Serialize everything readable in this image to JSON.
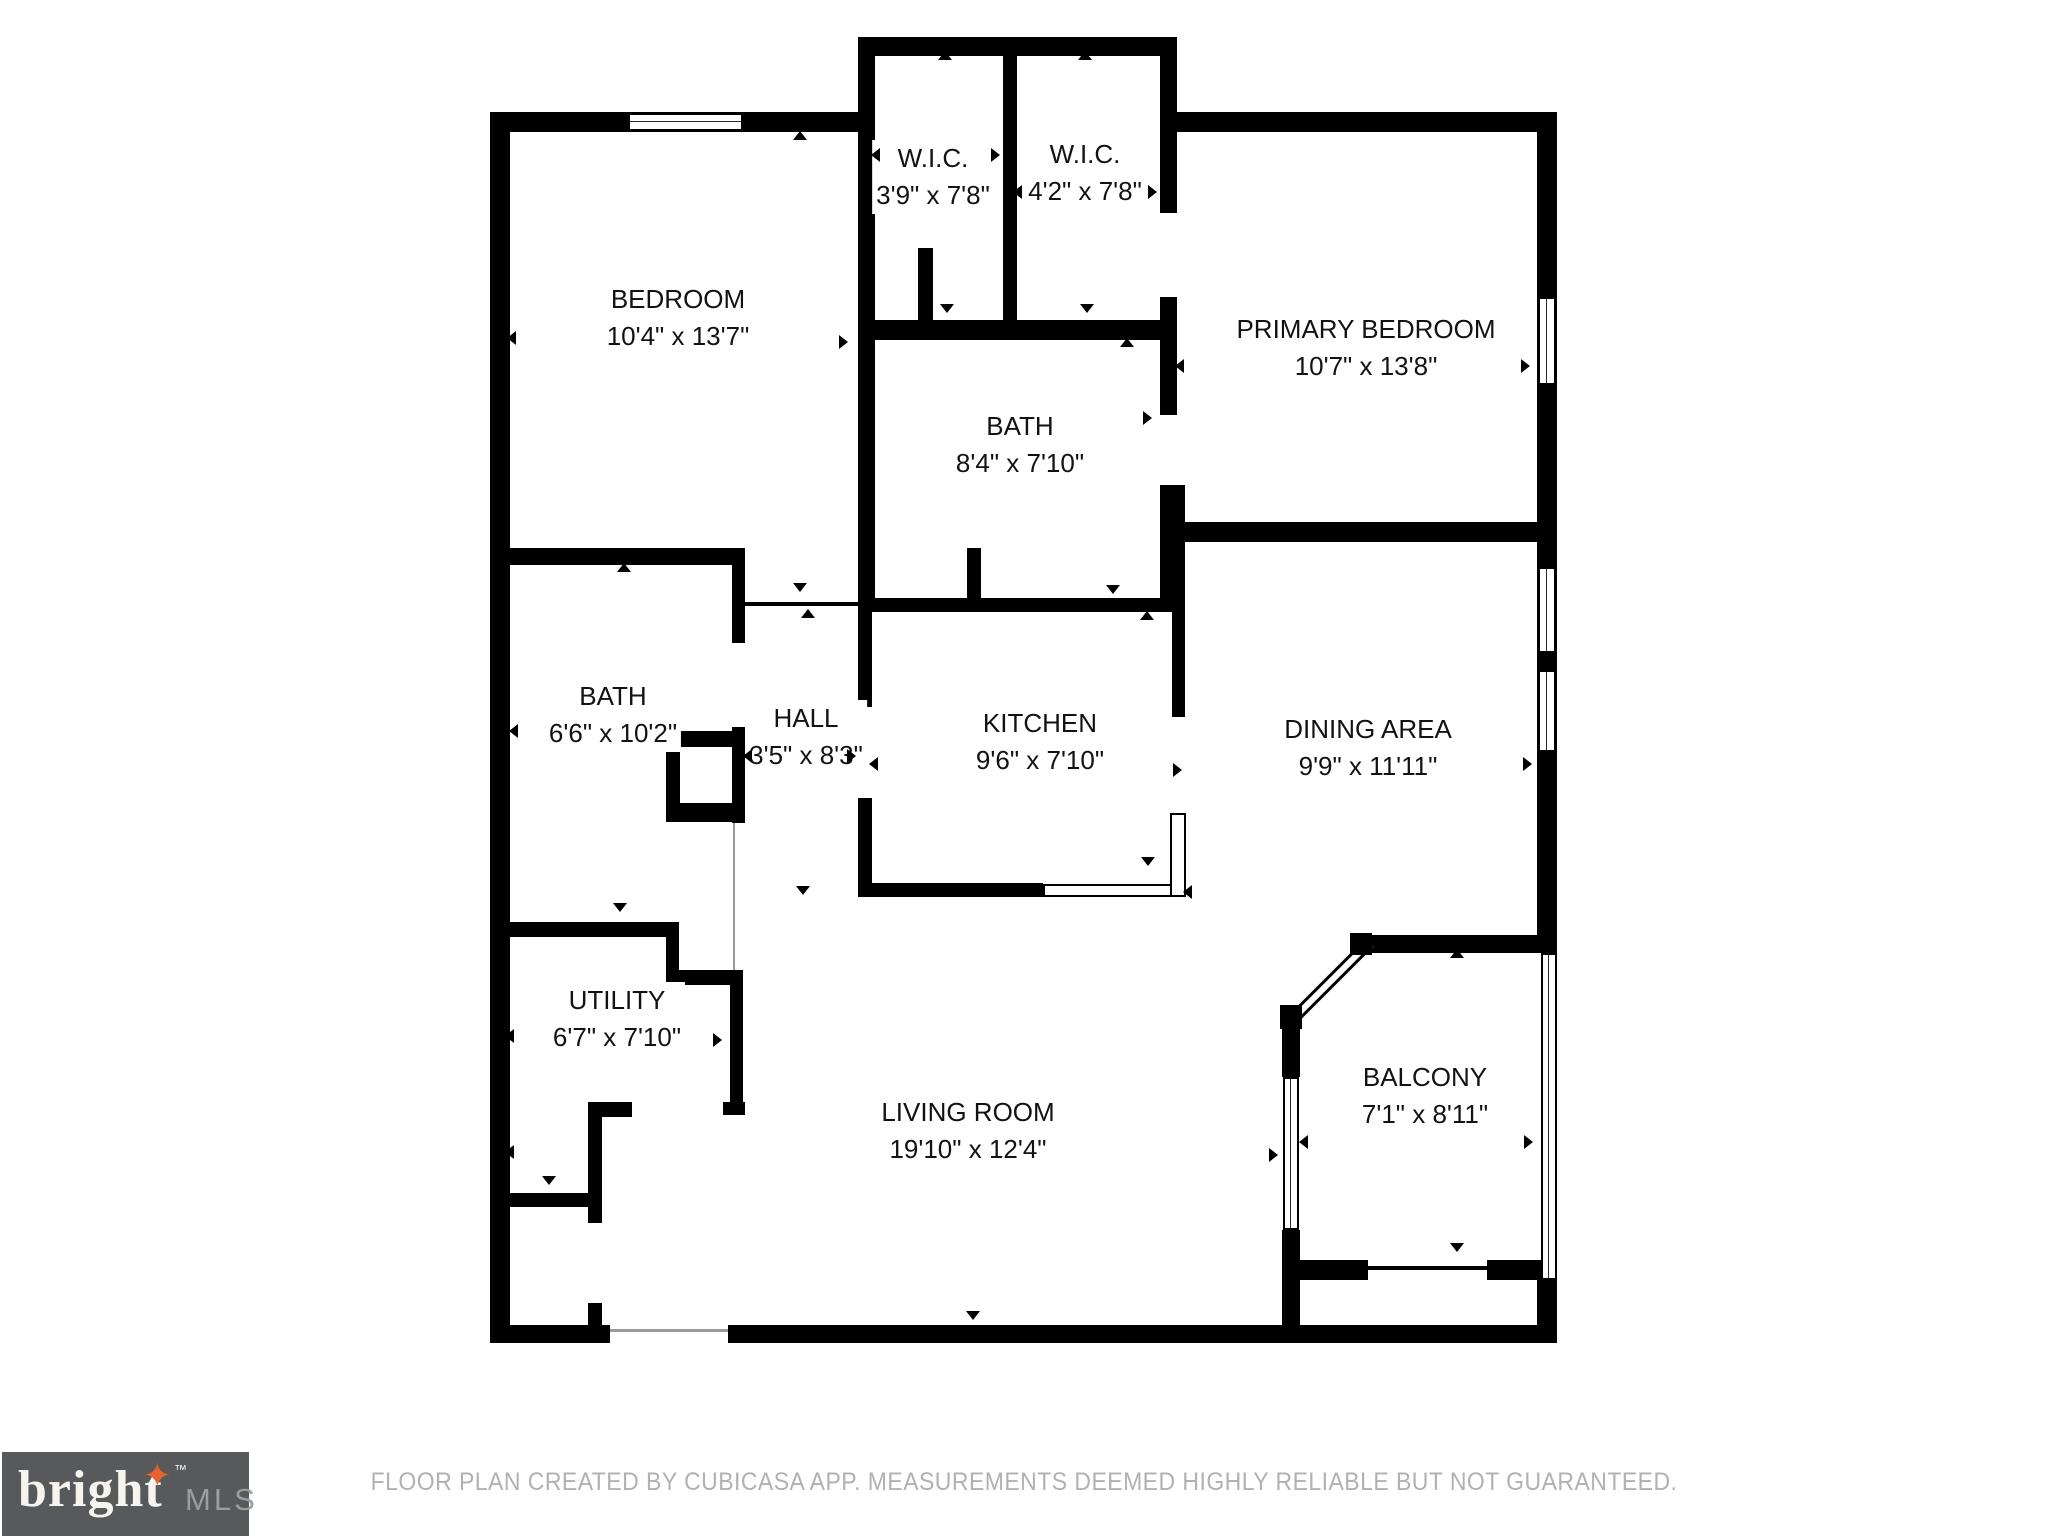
{
  "rooms": [
    {
      "name": "W.I.C.",
      "dims": "3'9\" x 7'8\""
    },
    {
      "name": "W.I.C.",
      "dims": "4'2\" x 7'8\""
    },
    {
      "name": "BEDROOM",
      "dims": "10'4\" x 13'7\""
    },
    {
      "name": "PRIMARY BEDROOM",
      "dims": "10'7\" x 13'8\""
    },
    {
      "name": "BATH",
      "dims": "8'4\" x 7'10\""
    },
    {
      "name": "BATH",
      "dims": "6'6\" x 10'2\""
    },
    {
      "name": "HALL",
      "dims": "3'5\" x 8'3\""
    },
    {
      "name": "KITCHEN",
      "dims": "9'6\" x 7'10\""
    },
    {
      "name": "DINING AREA",
      "dims": "9'9\" x 11'11\""
    },
    {
      "name": "UTILITY",
      "dims": "6'7\" x 7'10\""
    },
    {
      "name": "LIVING ROOM",
      "dims": "19'10\" x 12'4\""
    },
    {
      "name": "BALCONY",
      "dims": "7'1\" x 8'11\""
    }
  ],
  "footer": {
    "disclaimer": "FLOOR PLAN CREATED BY CUBICASA APP. MEASUREMENTS DEEMED HIGHLY RELIABLE BUT NOT GUARANTEED."
  },
  "logo": {
    "brand": "bright",
    "star": "✦",
    "tm": "™",
    "suffix": "MLS"
  },
  "colors": {
    "wall": "#000000",
    "label_text": "#121212",
    "footer_text": "#B1B1B1",
    "logo_bg": "#58595B",
    "logo_brand": "#F6F4EF",
    "logo_star": "#E8622D",
    "logo_mls": "#9B9DA0"
  }
}
